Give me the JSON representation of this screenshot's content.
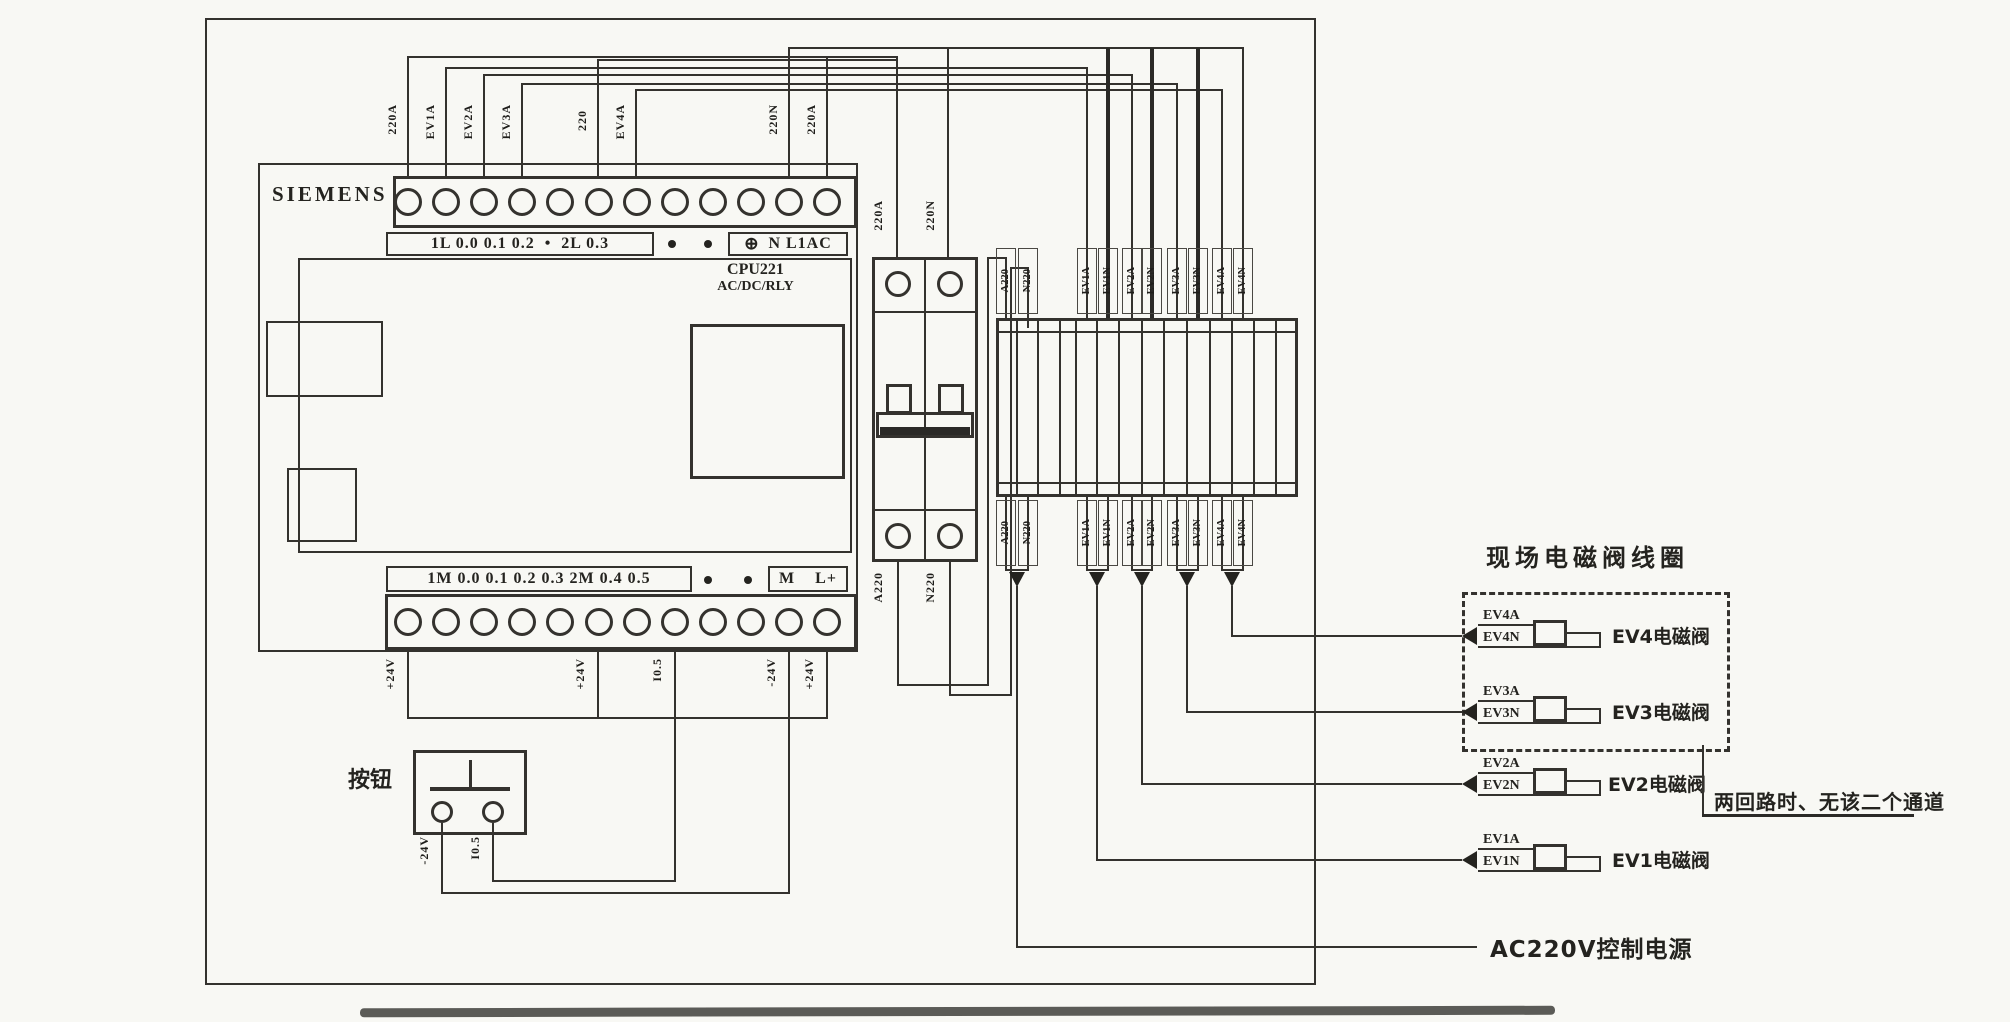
{
  "plc": {
    "brand": "SIEMENS",
    "model": "CPU221",
    "model_sub": "AC/DC/RLY",
    "top_row_left": "1L 0.0 0.1 0.2  •  2L 0.3",
    "earth": "⊕",
    "top_row_right": "N L1AC",
    "bottom_row_left": "1M 0.0 0.1 0.2 0.3 2M 0.4 0.5",
    "bottom_row_right": "M    L+"
  },
  "top_wires": {
    "t1": "220A",
    "t2": "EV1A",
    "t3": "EV2A",
    "t4": "EV3A",
    "t5": "220",
    "t6": "EV4A",
    "t7": "220N",
    "t8": "220A"
  },
  "breaker_wires": {
    "top_a": "220A",
    "top_n": "220N",
    "bottom_a": "A220",
    "bottom_n": "N220"
  },
  "strip": {
    "top": {
      "c1": "A220",
      "c2": "N220",
      "c3": "EV1A",
      "c4": "EV1N",
      "c5": "EV2A",
      "c6": "EV2N",
      "c7": "EV3A",
      "c8": "EV3N",
      "c9": "EV4A",
      "c10": "EV4N"
    },
    "bottom": {
      "c1": "A220",
      "c2": "N220",
      "c3": "EV1A",
      "c4": "EV1N",
      "c5": "EV2A",
      "c6": "EV2N",
      "c7": "EV3A",
      "c8": "EV3N",
      "c9": "EV4A",
      "c10": "EV4N"
    }
  },
  "plc_bottom_wires": {
    "b1": "+24V",
    "b2": "+24V",
    "b3": "I0.5",
    "b4": "-24V",
    "b5": "+24V"
  },
  "button": {
    "label": "按钮",
    "left_wire": "-24V",
    "right_wire": "I0.5"
  },
  "field": {
    "title": "现场电磁阀线圈",
    "valves": {
      "ev4": {
        "a": "EV4A",
        "n": "EV4N",
        "name": "EV4电磁阀"
      },
      "ev3": {
        "a": "EV3A",
        "n": "EV3N",
        "name": "EV3电磁阀"
      },
      "ev2": {
        "a": "EV2A",
        "n": "EV2N",
        "name": "EV2电磁阀"
      },
      "ev1": {
        "a": "EV1A",
        "n": "EV1N",
        "name": "EV1电磁阀"
      }
    },
    "note": "两回路时、无该二个通道",
    "power_label": "AC220V控制电源"
  }
}
